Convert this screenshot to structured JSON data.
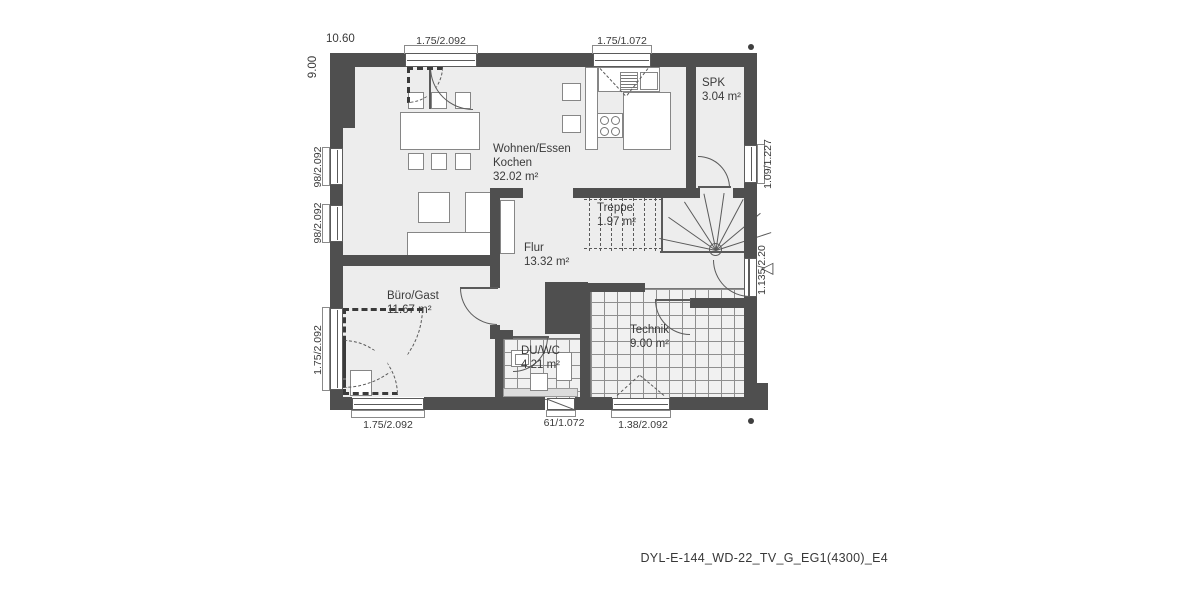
{
  "rooms": {
    "wohnen": {
      "name": "Wohnen/Essen",
      "name2": "Kochen",
      "area": "32.02 m²"
    },
    "spk": {
      "name": "SPK",
      "area": "3.04 m²"
    },
    "treppe": {
      "name": "Treppe",
      "area": "1.97 m²"
    },
    "flur": {
      "name": "Flur",
      "area": "13.32 m²"
    },
    "buero": {
      "name": "Büro/Gast",
      "area": "11.67 m²"
    },
    "duwc": {
      "name": "DU/WC",
      "area": "4.21 m²"
    },
    "technik": {
      "name": "Technik",
      "area": "9.00 m²"
    }
  },
  "dims": {
    "overall_width": "10.60",
    "overall_height": "9.00",
    "top_terrace_door": "1.75/2.092",
    "top_kitchen_window": "1.75/1.072",
    "left_window_upper": "98/2.092",
    "left_window_lower": "98/2.092",
    "left_buero_window": "1.75/2.092",
    "right_spk_window": "1.09/1.227",
    "right_entry_door": "1.135/2.20",
    "bottom_buero_window": "1.75/2.092",
    "bottom_duwc_window": "61/1.072",
    "bottom_technik_window": "1.38/2.092"
  },
  "markers": {
    "entrance_arrow": "◁"
  },
  "footer": {
    "drawing_code": "DYL-E-144_WD-22_TV_G_EG1(4300)_E4"
  },
  "colors": {
    "wall": "#4f4f4f",
    "floor": "#ededed",
    "line": "#5a5a5a",
    "text": "#3a3a3a"
  }
}
